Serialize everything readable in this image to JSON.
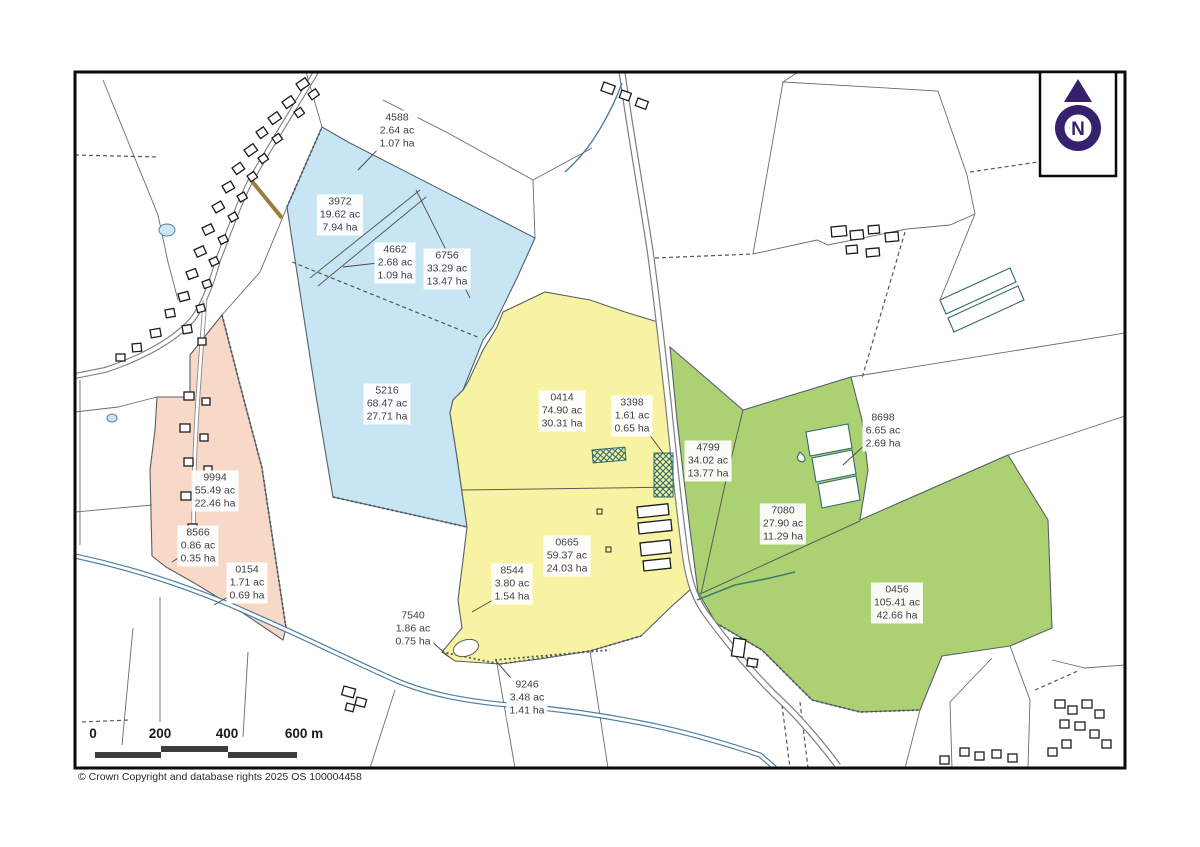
{
  "map": {
    "copyright": "© Crown Copyright and database rights 2025 OS 100004458",
    "north": {
      "label": "N"
    },
    "scale_bar": {
      "unit": "m",
      "ticks": [
        {
          "label": "0",
          "x": 93
        },
        {
          "label": "200",
          "x": 160
        },
        {
          "label": "400",
          "x": 227
        },
        {
          "label": "600 m",
          "x": 304
        }
      ]
    },
    "colors": {
      "blue_parcel": "#c7e5f2",
      "yellow_parcel": "#f8f2a3",
      "green_parcel": "#acd173",
      "pink_parcel": "#f8d8c7",
      "water": "#4d7fa6",
      "north_purple": "#37206e",
      "crosshatch_teal": "#2e6b6b"
    },
    "parcels": [
      {
        "number": "4588",
        "acres": "2.64 ac",
        "hectares": "1.07 ha",
        "color": "white",
        "x": 397,
        "y": 131,
        "leader": [
          383,
          144,
          358,
          170
        ]
      },
      {
        "number": "3972",
        "acres": "19.62 ac",
        "hectares": "7.94 ha",
        "color": "blue",
        "x": 340,
        "y": 215
      },
      {
        "number": "4662",
        "acres": "2.68 ac",
        "hectares": "1.09 ha",
        "color": "blue",
        "x": 395,
        "y": 263,
        "leader": [
          378,
          263,
          343,
          267
        ]
      },
      {
        "number": "6756",
        "acres": "33.29 ac",
        "hectares": "13.47 ha",
        "color": "blue",
        "x": 447,
        "y": 269
      },
      {
        "number": "5216",
        "acres": "68.47 ac",
        "hectares": "27.71 ha",
        "color": "blue",
        "x": 387,
        "y": 404
      },
      {
        "number": "0414",
        "acres": "74.90 ac",
        "hectares": "30.31 ha",
        "color": "yellow",
        "x": 562,
        "y": 411
      },
      {
        "number": "3398",
        "acres": "1.61 ac",
        "hectares": "0.65 ha",
        "color": "yellow",
        "x": 632,
        "y": 416,
        "leader": [
          646,
          430,
          663,
          453
        ]
      },
      {
        "number": "4799",
        "acres": "34.02 ac",
        "hectares": "13.77 ha",
        "color": "green",
        "x": 708,
        "y": 461
      },
      {
        "number": "8698",
        "acres": "6.65 ac",
        "hectares": "2.69 ha",
        "color": "white",
        "x": 883,
        "y": 431,
        "leader": [
          868,
          442,
          843,
          465
        ]
      },
      {
        "number": "9994",
        "acres": "55.49 ac",
        "hectares": "22.46 ha",
        "color": "pink",
        "x": 215,
        "y": 491
      },
      {
        "number": "8566",
        "acres": "0.86 ac",
        "hectares": "0.35 ha",
        "color": "pink",
        "x": 198,
        "y": 546,
        "leader": [
          186,
          553,
          172,
          562
        ]
      },
      {
        "number": "0154",
        "acres": "1.71 ac",
        "hectares": "0.69 ha",
        "color": "pink",
        "x": 247,
        "y": 583,
        "leader": [
          233,
          594,
          214,
          605
        ]
      },
      {
        "number": "0665",
        "acres": "59.37 ac",
        "hectares": "24.03 ha",
        "color": "yellow",
        "x": 567,
        "y": 556
      },
      {
        "number": "8544",
        "acres": "3.80 ac",
        "hectares": "1.54 ha",
        "color": "yellow",
        "x": 512,
        "y": 584,
        "leader": [
          500,
          596,
          472,
          612
        ]
      },
      {
        "number": "7080",
        "acres": "27.90 ac",
        "hectares": "11.29 ha",
        "color": "green",
        "x": 783,
        "y": 524
      },
      {
        "number": "0456",
        "acres": "105.41 ac",
        "hectares": "42.66 ha",
        "color": "green",
        "x": 897,
        "y": 603
      },
      {
        "number": "7540",
        "acres": "1.86 ac",
        "hectares": "0.75 ha",
        "color": "yellow",
        "x": 413,
        "y": 629,
        "leader": [
          428,
          638,
          449,
          657
        ]
      },
      {
        "number": "9246",
        "acres": "3.48 ac",
        "hectares": "1.41 ha",
        "color": "yellow",
        "x": 527,
        "y": 698,
        "leader": [
          518,
          686,
          496,
          661
        ]
      }
    ]
  }
}
